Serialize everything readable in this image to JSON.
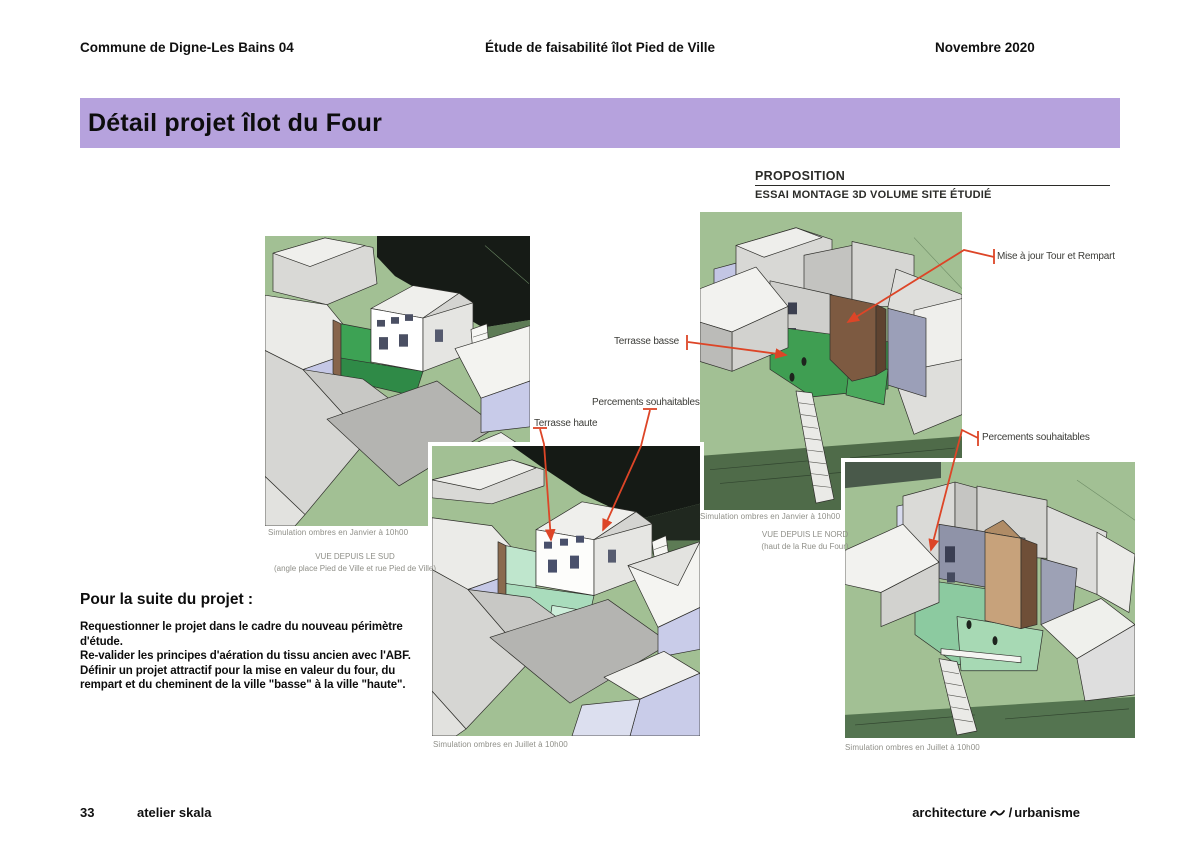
{
  "header": {
    "left": "Commune de Digne-Les Bains 04",
    "center": "Étude de faisabilité îlot Pied de Ville",
    "right": "Novembre 2020"
  },
  "title_banner": "Détail projet îlot du Four",
  "proposition": {
    "heading": "PROPOSITION",
    "subheading": "ESSAI MONTAGE 3D VOLUME SITE ÉTUDIÉ"
  },
  "annotations": {
    "mise_a_jour": "Mise à jour Tour et Rempart",
    "terrasse_basse": "Terrasse basse",
    "percements_left": "Percements souhaitables",
    "terrasse_haute": "Terrasse haute",
    "percements_right": "Percements souhaitables"
  },
  "figures": {
    "south_winter_caption": "Simulation ombres en Janvier à 10h00",
    "south_view_title": "VUE DEPUIS LE SUD",
    "south_view_subtitle": "(angle place Pied de Ville et rue Pied de Ville)",
    "south_summer_caption": "Simulation ombres en Juillet à 10h00",
    "north_winter_caption": "Simulation ombres en Janvier à 10h00",
    "north_view_title": "VUE DEPUIS LE NORD",
    "north_view_subtitle": "(haut de la Rue du Four)",
    "north_summer_caption": "Simulation ombres en Juillet à 10h00"
  },
  "next_steps": {
    "heading": "Pour la suite du projet :",
    "items": [
      "Requestionner le projet dans le cadre du nouveau périmètre d'étude.",
      "Re-valider les principes d'aération du tissu ancien avec l'ABF.",
      "Définir un projet attractif pour la mise en valeur du four, du rempart et du cheminent de la ville \"basse\" à la ville \"haute\"."
    ]
  },
  "footer": {
    "page_number": "33",
    "studio": "atelier skala",
    "tagline_left": "architecture",
    "tagline_sep": "/",
    "tagline_right": "urbanisme"
  },
  "colors": {
    "banner_bg": "#b6a2dd",
    "annotation_red": "#dd4527",
    "ground_green": "#a2c094"
  }
}
